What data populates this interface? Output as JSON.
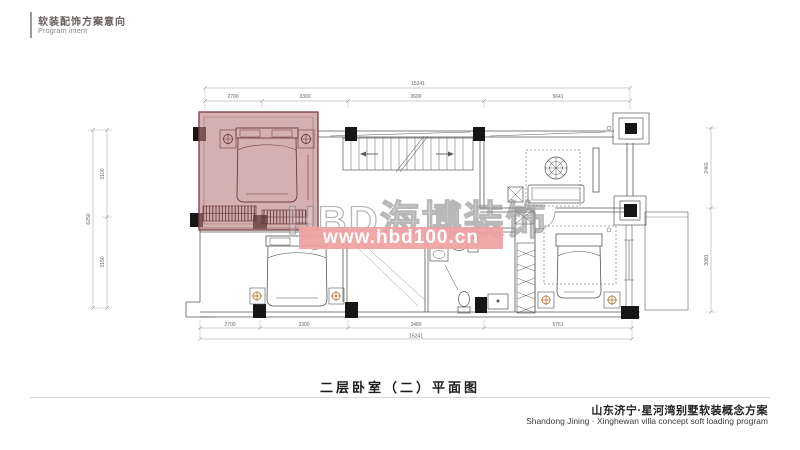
{
  "header": {
    "title_cn": "软装配饰方案意向",
    "title_en": "Program intent"
  },
  "plan": {
    "caption": "二层卧室（二）平面图",
    "dims": {
      "top_total": "15241",
      "top_segments": [
        "2700",
        "3300",
        "3600",
        "5641"
      ],
      "bottom_segments": [
        "2700",
        "3300",
        "3480",
        "5761"
      ],
      "bottom_total": "15241",
      "left_total": "6250",
      "left_segments": [
        "3100",
        "3150"
      ],
      "right_segments": [
        "2460",
        "3081"
      ]
    }
  },
  "watermark": {
    "brand": "HBD海博装饰",
    "url": "www.hbd100.cn",
    "band_color": "#f0a2a2"
  },
  "footer": {
    "title_cn": "山东济宁·星河湾别墅软装概念方案",
    "title_en": "Shandong Jining · Xinghewan villa concept soft loading program"
  },
  "colors": {
    "highlight_fill": "#b97f7f",
    "highlight_line": "#6d3a3a",
    "plan_line": "#5a5a5a",
    "column_black": "#161616",
    "lamp_accent": "#b87333",
    "dim_line": "#999999"
  }
}
